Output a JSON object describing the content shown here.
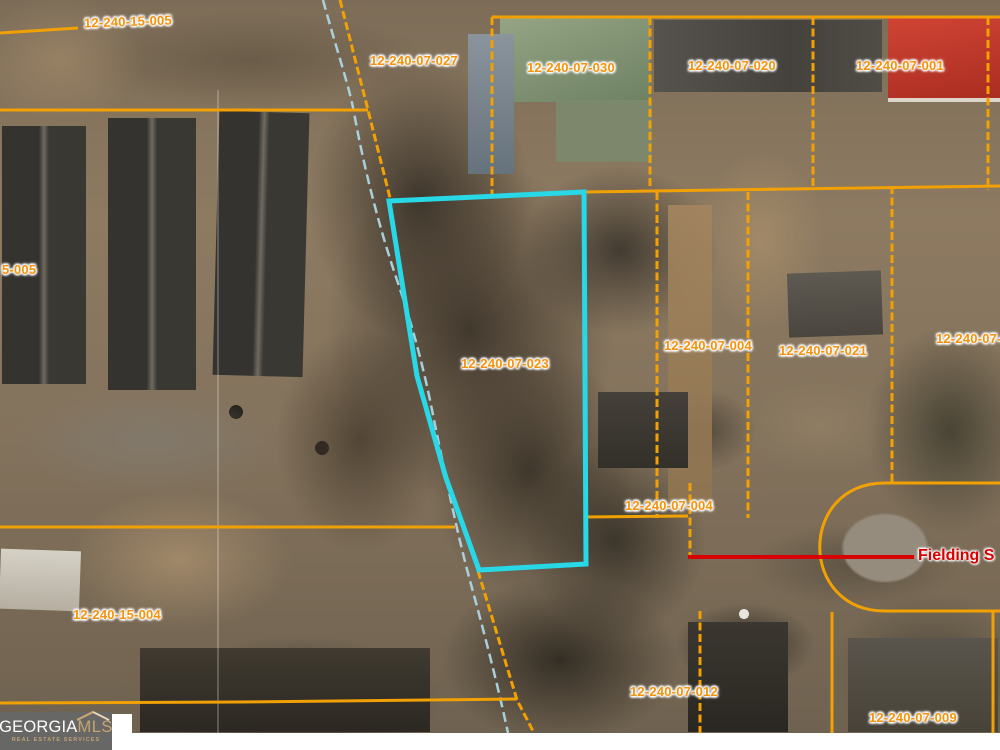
{
  "map": {
    "parcel_labels": [
      {
        "text": "12-240-15-005"
      },
      {
        "text": "12-240-07-027"
      },
      {
        "text": "12-240-07-030"
      },
      {
        "text": "12-240-07-020"
      },
      {
        "text": "12-240-07-001"
      },
      {
        "text": "5-005"
      },
      {
        "text": "12-240-07-023"
      },
      {
        "text": "12-240-07-004"
      },
      {
        "text": "12-240-07-021"
      },
      {
        "text": "12-240-07-0"
      },
      {
        "text": "12-240-07-004"
      },
      {
        "text": "12-240-15-004"
      },
      {
        "text": "12-240-07-012"
      },
      {
        "text": "12-240-07-009"
      }
    ],
    "street_label": "Fielding S",
    "highlighted_parcel_id": "12-240-07-023",
    "colors": {
      "parcel_line": "#f1a104",
      "parcel_label": "#f4930b",
      "highlight_outline": "#28d8e6",
      "street_line": "#d80000",
      "stream": "#aed6e4"
    }
  },
  "watermark": {
    "brand_georgia": "GEORGIA",
    "brand_mls": "MLS",
    "tagline": "REAL ESTATE SERVICES"
  }
}
